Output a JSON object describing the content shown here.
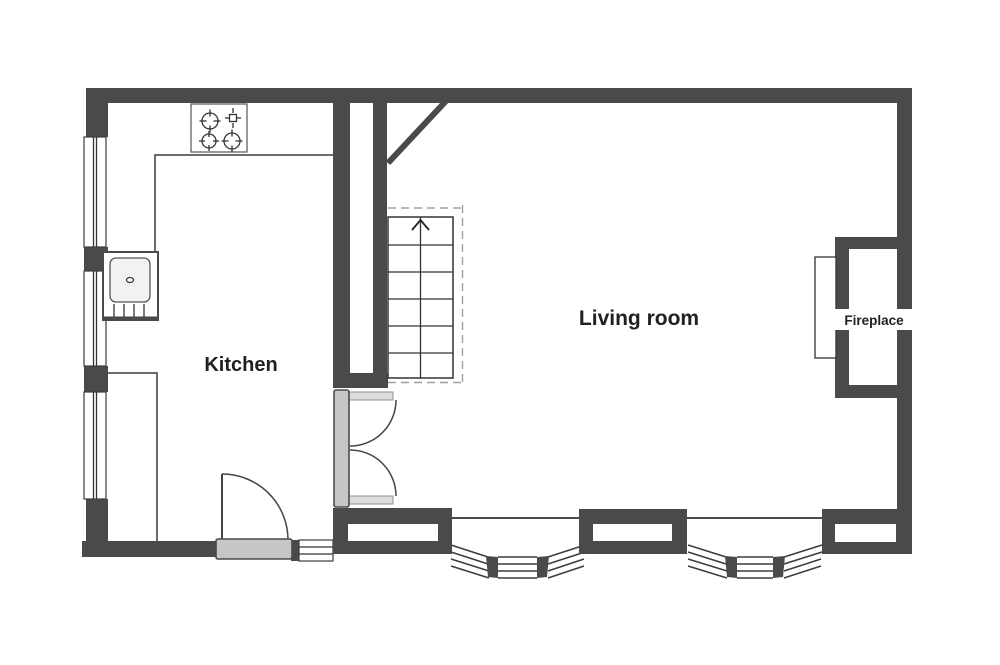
{
  "plan": {
    "labels": {
      "kitchen": "Kitchen",
      "living_room": "Living room",
      "fireplace": "Fireplace"
    },
    "fixtures": [
      "stove",
      "sink",
      "staircase-up",
      "double-doors",
      "hinged-door",
      "bay-window",
      "bay-window",
      "fireplace",
      "hearth",
      "window"
    ],
    "colors": {
      "wall": "#4a4a4a",
      "line": "#3c3c3c",
      "detail": "#333333",
      "door": "#c6c6c6",
      "tab": "#dcdcdc",
      "sink": "#f2f2f2",
      "dashed": "#a0a0a0",
      "text": "#212121",
      "bg": "#ffffff"
    }
  }
}
